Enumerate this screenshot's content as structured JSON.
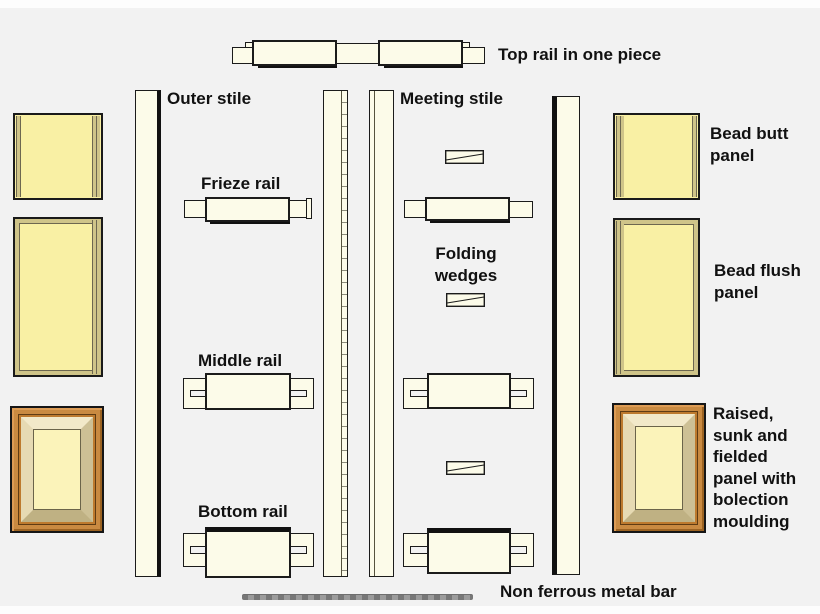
{
  "title": "Door construction components diagram",
  "labels": {
    "top_rail": "Top rail in one piece",
    "outer_stile": "Outer stile",
    "meeting_stile": "Meeting stile",
    "frieze_rail": "Frieze rail",
    "middle_rail": "Middle rail",
    "bottom_rail": "Bottom rail",
    "folding_wedges": [
      "Folding",
      "wedges"
    ],
    "bead_butt": [
      "Bead butt",
      "panel"
    ],
    "bead_flush": [
      "Bead flush",
      "panel"
    ],
    "raised_panel": [
      "Raised,",
      "sunk and",
      "fielded",
      "panel with",
      "bolection",
      "moulding"
    ],
    "metal_bar": "Non ferrous metal bar"
  },
  "colors": {
    "background": "#f2f2f2",
    "wood_cream": "#fcfbe9",
    "panel_yellow": "#f9f0a4",
    "bead_tan": "#cfc489",
    "bead_line": "#6d6750",
    "frame_orange": "#c98a41",
    "frame_orange_dark": "#bd7a2e",
    "bevel_light": "#f2e9c9",
    "bevel_dark": "#bfb183",
    "panel_centre_yellow": "#fbf3ba",
    "outline_black": "#1b1b1b",
    "metal_gray": "#8a8a8a",
    "label_text": "#111111"
  }
}
